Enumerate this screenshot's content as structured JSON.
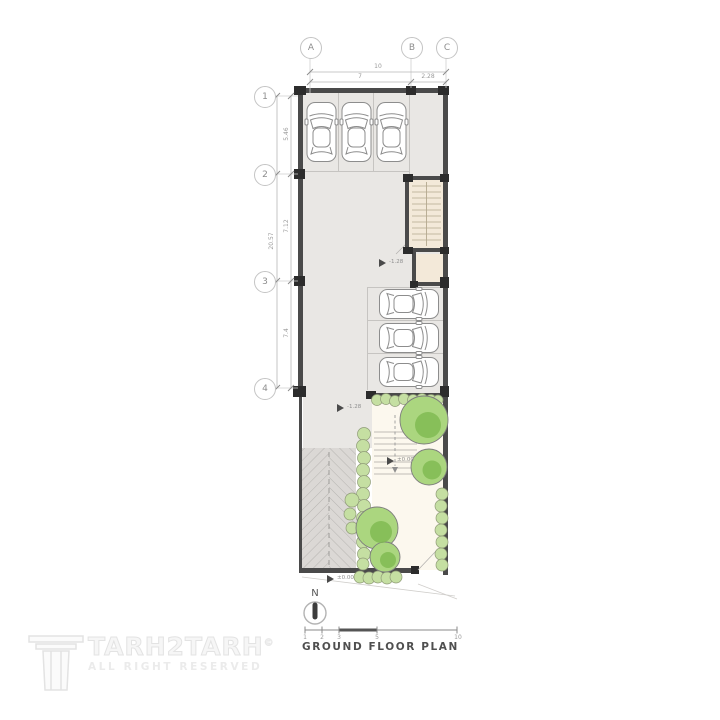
{
  "plan": {
    "title": "GROUND FLOOR PLAN"
  },
  "north": {
    "label": "N"
  },
  "grid": {
    "cols": [
      {
        "label": "A"
      },
      {
        "label": "B"
      },
      {
        "label": "C"
      }
    ],
    "rows": [
      {
        "label": "1"
      },
      {
        "label": "2"
      },
      {
        "label": "3"
      },
      {
        "label": "4"
      }
    ]
  },
  "dims": {
    "top_total": "10",
    "top_left": "7",
    "top_right": "2.28",
    "left_total": "20.57",
    "left_12": "5.46",
    "left_23": "7.12",
    "left_34": "7.4"
  },
  "levels": {
    "stair": "-1.28",
    "garage": "-1.28",
    "yard": "±0.00",
    "entry": "±0.00"
  },
  "scalebar": {
    "labels": [
      "1",
      "2",
      "3",
      "5",
      "10"
    ]
  },
  "watermark": {
    "brand": "TARH2TARH",
    "copyright": "©",
    "subtitle": "ALL RIGHT RESERVED"
  },
  "colors": {
    "floor": "#e9e7e4",
    "ramp": "#dbd8d5",
    "stair": "#f3e9d9",
    "yard": "#fcf8ee",
    "wall": "#4a4a4a",
    "column": "#2c2c2c",
    "tree_light": "#abd67f",
    "tree_dark": "#7fba50",
    "hedge": "#c5dfa2"
  }
}
